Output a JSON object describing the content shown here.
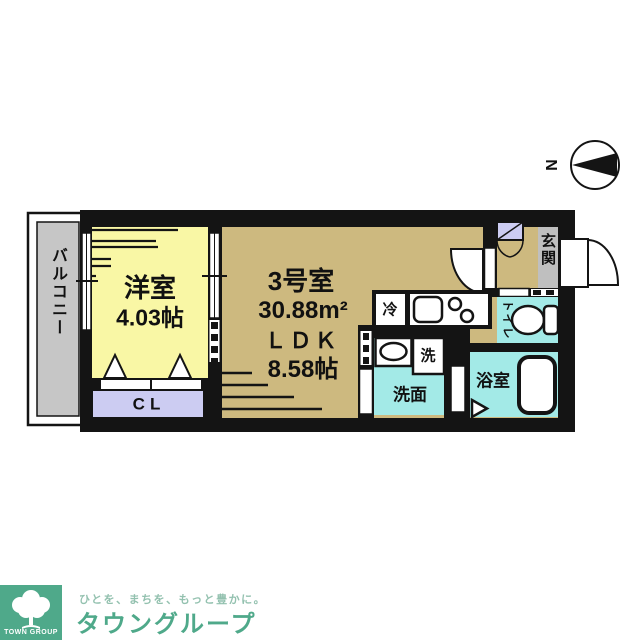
{
  "compass": {
    "north_label": "N"
  },
  "plan": {
    "balcony_label": "バルコニー",
    "western_room": {
      "name": "洋室",
      "size": "4.03帖"
    },
    "unit": {
      "name": "3号室",
      "area": "30.88m²",
      "ldk_label": "ＬＤＫ",
      "ldk_size": "8.58帖"
    },
    "closet_label": "CL",
    "entrance_label": "玄関",
    "toilet_label": "トイレ",
    "bathroom_label": "浴室",
    "washroom_label": "洗面",
    "washer_label": "洗",
    "fridge_label": "冷"
  },
  "branding": {
    "square_label": "TOWN GROUP",
    "tagline": "ひとを、まちを、もっと豊かに。",
    "company": "タウングループ"
  },
  "colors": {
    "wall": "#141414",
    "room_yellow": "#f9f7a5",
    "room_tan": "#cdb97f",
    "room_cyan": "#a3eae7",
    "room_lavender": "#ccccf2",
    "balcony_gray": "#c6c6c6",
    "genkan_gray": "#bfbfbf",
    "brand_green": "#4fa98a",
    "tagline_green": "#93c1af"
  }
}
